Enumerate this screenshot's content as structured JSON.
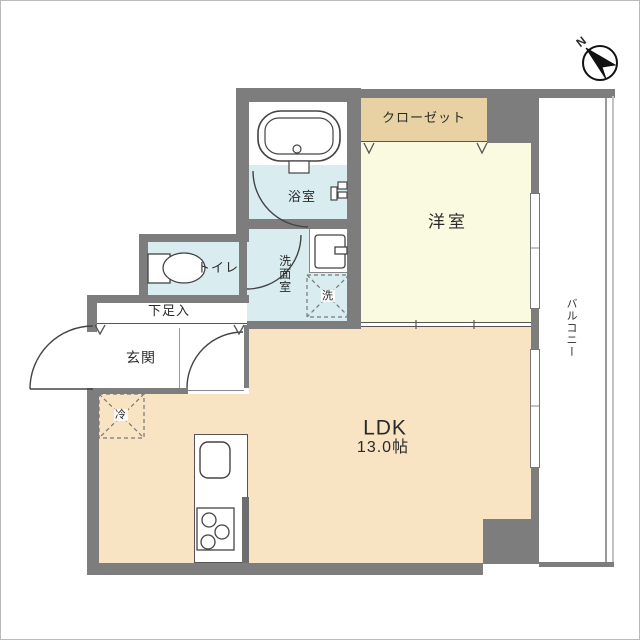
{
  "labels": {
    "closet": "クローゼット",
    "western_room": "洋室",
    "bathroom": "浴室",
    "washroom": "洗面室",
    "washer": "洗",
    "toilet": "トイレ",
    "shoe_storage": "下足入",
    "entrance": "玄関",
    "ldk_name": "LDK",
    "ldk_size": "13.0帖",
    "balcony": "バルコニー",
    "fridge": "冷",
    "compass_north": "N"
  },
  "colors": {
    "wall": "#7d7d7d",
    "ldk_floor": "#f8e3c2",
    "western_floor": "#fafae1",
    "closet_fill": "#e8d2a4",
    "wet_floor": "#d9edf1",
    "line": "#444444",
    "railing": "#9a9a9a"
  }
}
